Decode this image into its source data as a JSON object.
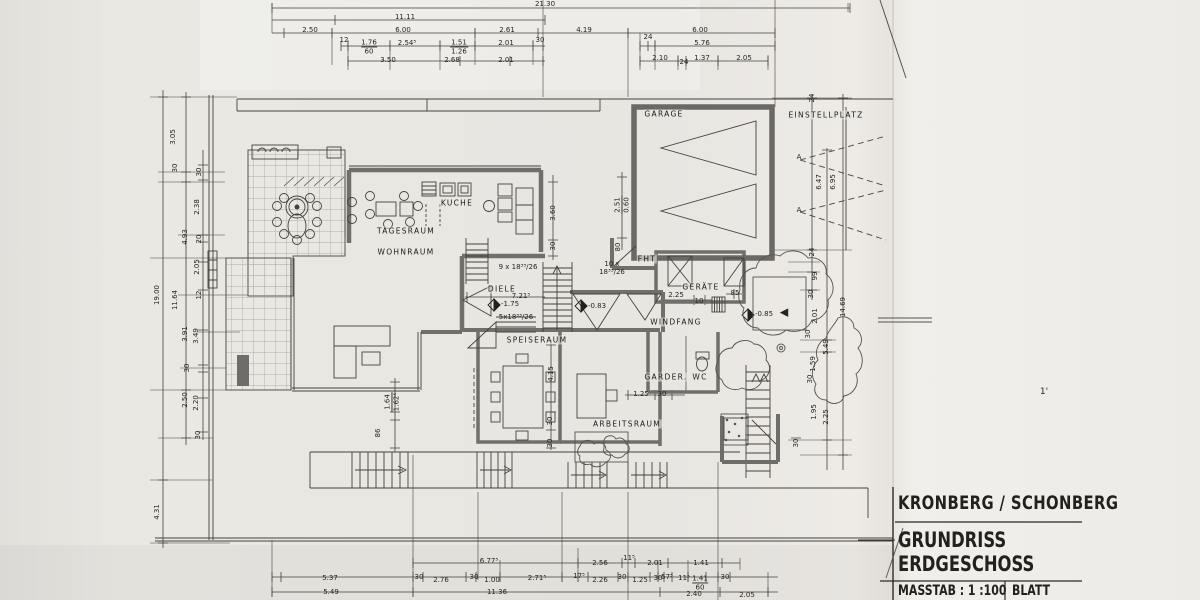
{
  "palette": {
    "paper": "#e9e7e2",
    "ink": "#3a3833",
    "wall_gray": "#716f6a",
    "pattern_gray": "#a09d97"
  },
  "title_block": {
    "project": "KRONBERG / SCHONBERG",
    "drawing_line1": "GRUNDRISS",
    "drawing_line2": "ERDGESCHOSS",
    "scale_label": "MASSTAB : 1 :100",
    "sheet_label": "BLATT"
  },
  "rooms": [
    {
      "v": "GARAGE",
      "x": 664,
      "y": 114
    },
    {
      "v": "EINSTELLPLATZ",
      "x": 826,
      "y": 115
    },
    {
      "v": "KUCHE",
      "x": 457,
      "y": 203
    },
    {
      "v": "TAGESRAUM",
      "x": 406,
      "y": 231
    },
    {
      "v": "WOHNRAUM",
      "x": 406,
      "y": 252
    },
    {
      "v": "DIELE",
      "x": 502,
      "y": 289
    },
    {
      "v": "SPEISERAUM",
      "x": 537,
      "y": 340
    },
    {
      "v": "WINDFANG",
      "x": 676,
      "y": 322
    },
    {
      "v": "ARBEITSRAUM",
      "x": 627,
      "y": 424
    },
    {
      "v": "GARDER.",
      "x": 666,
      "y": 377
    },
    {
      "v": "WC",
      "x": 700,
      "y": 377
    },
    {
      "v": "FHT",
      "x": 647,
      "y": 259
    },
    {
      "v": "GERÄTE",
      "x": 701,
      "y": 287
    }
  ],
  "dims": {
    "top": [
      {
        "v": "21.30",
        "x": 545,
        "y": 4
      },
      {
        "v": "11.11",
        "x": 405,
        "y": 17
      },
      {
        "v": "2.50",
        "x": 310,
        "y": 30
      },
      {
        "v": "6.00",
        "x": 403,
        "y": 30
      },
      {
        "v": "2.61",
        "x": 507,
        "y": 30
      },
      {
        "v": "4.19",
        "x": 584,
        "y": 30
      },
      {
        "v": "6.00",
        "x": 700,
        "y": 30
      },
      {
        "v": "12",
        "x": 344,
        "y": 40
      },
      {
        "v": "1.76",
        "v2": "60",
        "x": 369,
        "y": 47
      },
      {
        "v": "2.54⁵",
        "x": 407,
        "y": 43
      },
      {
        "v": "1.51",
        "v2": "1.26",
        "x": 459,
        "y": 47
      },
      {
        "v": "2.01",
        "x": 506,
        "y": 43
      },
      {
        "v": "30",
        "x": 540,
        "y": 40
      },
      {
        "v": "24",
        "x": 648,
        "y": 37
      },
      {
        "v": "5.76",
        "x": 702,
        "y": 43
      },
      {
        "v": "3.50",
        "x": 388,
        "y": 60
      },
      {
        "v": "2.68",
        "x": 452,
        "y": 60
      },
      {
        "v": "2.01",
        "x": 506,
        "y": 60
      },
      {
        "v": "2.10",
        "x": 660,
        "y": 58
      },
      {
        "v": "24",
        "x": 684,
        "y": 62
      },
      {
        "v": "1.37",
        "x": 702,
        "y": 58
      },
      {
        "v": "2.05",
        "x": 744,
        "y": 58
      }
    ],
    "left": [
      {
        "v": "19.00",
        "x": 157,
        "y": 295,
        "rot": -90
      },
      {
        "v": "4.31",
        "x": 157,
        "y": 512,
        "rot": -90
      },
      {
        "v": "3.05",
        "x": 173,
        "y": 137,
        "rot": -90
      },
      {
        "v": "30",
        "x": 175,
        "y": 168,
        "rot": -90
      },
      {
        "v": "11.64",
        "x": 175,
        "y": 300,
        "rot": -90
      },
      {
        "v": "30",
        "x": 199,
        "y": 172,
        "rot": -90
      },
      {
        "v": "2.38",
        "x": 197,
        "y": 207,
        "rot": -90
      },
      {
        "v": "4.93",
        "x": 185,
        "y": 237,
        "rot": -90
      },
      {
        "v": "20",
        "x": 199,
        "y": 239,
        "rot": -90
      },
      {
        "v": "2.05",
        "x": 197,
        "y": 267,
        "rot": -90
      },
      {
        "v": "12",
        "x": 199,
        "y": 295,
        "rot": -90
      },
      {
        "v": "3.91",
        "x": 185,
        "y": 334,
        "rot": -90
      },
      {
        "v": "3.49",
        "x": 196,
        "y": 336,
        "rot": -90
      },
      {
        "v": "30",
        "x": 187,
        "y": 368,
        "rot": -90
      },
      {
        "v": "2.50",
        "x": 185,
        "y": 400,
        "rot": -90
      },
      {
        "v": "2.20",
        "x": 196,
        "y": 403,
        "rot": -90
      },
      {
        "v": "30",
        "x": 198,
        "y": 435,
        "rot": -90
      }
    ],
    "right": [
      {
        "v": "24",
        "x": 812,
        "y": 98,
        "rot": -90
      },
      {
        "v": "6.47",
        "x": 819,
        "y": 182,
        "rot": -90
      },
      {
        "v": "6.95",
        "x": 833,
        "y": 182,
        "rot": -90
      },
      {
        "v": "24",
        "x": 812,
        "y": 252,
        "rot": -90
      },
      {
        "v": "99",
        "x": 815,
        "y": 276,
        "rot": -90
      },
      {
        "v": "30",
        "x": 811,
        "y": 294,
        "rot": -90
      },
      {
        "v": "2.01",
        "x": 815,
        "y": 316,
        "rot": -90
      },
      {
        "v": "30",
        "x": 808,
        "y": 334,
        "rot": -90
      },
      {
        "v": "5.49",
        "x": 826,
        "y": 347,
        "rot": -90
      },
      {
        "v": "1.59",
        "x": 813,
        "y": 364,
        "rot": -90
      },
      {
        "v": "30",
        "x": 810,
        "y": 379,
        "rot": -90
      },
      {
        "v": "14.69",
        "x": 843,
        "y": 307,
        "rot": -90
      },
      {
        "v": "1.95",
        "x": 814,
        "y": 412,
        "rot": -90
      },
      {
        "v": "2.25",
        "x": 826,
        "y": 417,
        "rot": -90
      },
      {
        "v": "30",
        "x": 796,
        "y": 443,
        "rot": -90
      }
    ],
    "bottom": [
      {
        "v": "6.77⁵",
        "x": 489,
        "y": 561
      },
      {
        "v": "2.56",
        "x": 600,
        "y": 563
      },
      {
        "v": "11⁵",
        "x": 629,
        "y": 558
      },
      {
        "v": "2.01",
        "x": 655,
        "y": 563
      },
      {
        "v": "1.41",
        "x": 701,
        "y": 563
      },
      {
        "v": "5.37",
        "x": 330,
        "y": 578
      },
      {
        "v": "30",
        "x": 419,
        "y": 577
      },
      {
        "v": "2.76",
        "x": 441,
        "y": 580
      },
      {
        "v": "30",
        "x": 474,
        "y": 577
      },
      {
        "v": "1.00",
        "x": 492,
        "y": 580
      },
      {
        "v": "2.71⁵",
        "x": 537,
        "y": 578
      },
      {
        "v": "17⁵",
        "x": 579,
        "y": 576
      },
      {
        "v": "2.26",
        "x": 600,
        "y": 580
      },
      {
        "v": "30",
        "x": 622,
        "y": 577
      },
      {
        "v": "1.25",
        "x": 640,
        "y": 580
      },
      {
        "v": "30",
        "x": 658,
        "y": 578
      },
      {
        "v": "57⁵",
        "x": 667,
        "y": 577
      },
      {
        "v": "11⁵",
        "x": 684,
        "y": 578
      },
      {
        "v": "1.41",
        "v2": "60",
        "x": 700,
        "y": 583
      },
      {
        "v": "30",
        "x": 725,
        "y": 577
      },
      {
        "v": "5.49",
        "x": 331,
        "y": 592
      },
      {
        "v": "11.36",
        "x": 497,
        "y": 592
      },
      {
        "v": "2.40",
        "x": 694,
        "y": 594
      },
      {
        "v": "2.05",
        "x": 747,
        "y": 595
      }
    ],
    "inner": [
      {
        "v": "3.60",
        "x": 553,
        "y": 213,
        "rot": -90
      },
      {
        "v": "30",
        "x": 553,
        "y": 246,
        "rot": -90
      },
      {
        "v": "2.51",
        "v2": "0.60",
        "x": 622,
        "y": 205,
        "rot": -90
      },
      {
        "v": "80",
        "x": 618,
        "y": 247,
        "rot": -90
      },
      {
        "v": "9 x 18³³/26",
        "x": 518,
        "y": 267
      },
      {
        "v": "10 x",
        "v2": "18³³/26",
        "x": 612,
        "y": 268,
        "nb": 1
      },
      {
        "v": "5x18³³/26",
        "x": 516,
        "y": 317
      },
      {
        "v": "7.21⁵",
        "x": 521,
        "y": 296
      },
      {
        "v": "-1.75",
        "x": 510,
        "y": 304
      },
      {
        "v": "-0.83",
        "x": 597,
        "y": 306
      },
      {
        "v": "-0.85",
        "x": 764,
        "y": 314
      },
      {
        "v": "◀",
        "x": 784,
        "y": 313,
        "fs": 11
      },
      {
        "v": "2.25",
        "x": 676,
        "y": 295
      },
      {
        "v": "10",
        "x": 699,
        "y": 301
      },
      {
        "v": "85",
        "x": 735,
        "y": 293
      },
      {
        "v": "4.15",
        "x": 551,
        "y": 374,
        "rot": -90
      },
      {
        "v": "1.25",
        "x": 641,
        "y": 394
      },
      {
        "v": "30",
        "x": 662,
        "y": 394
      },
      {
        "v": "30",
        "x": 550,
        "y": 421,
        "rot": -90
      },
      {
        "v": "30",
        "x": 550,
        "y": 443,
        "rot": -90
      },
      {
        "v": "1.64",
        "v2": "1.62⁵",
        "x": 392,
        "y": 402,
        "rot": -90
      },
      {
        "v": "86",
        "x": 378,
        "y": 433,
        "rot": -90
      },
      {
        "v": "A",
        "x": 799,
        "y": 157
      },
      {
        "v": "A",
        "x": 799,
        "y": 210
      },
      {
        "v": "1'",
        "x": 1044,
        "y": 392,
        "fs": 9
      }
    ]
  }
}
